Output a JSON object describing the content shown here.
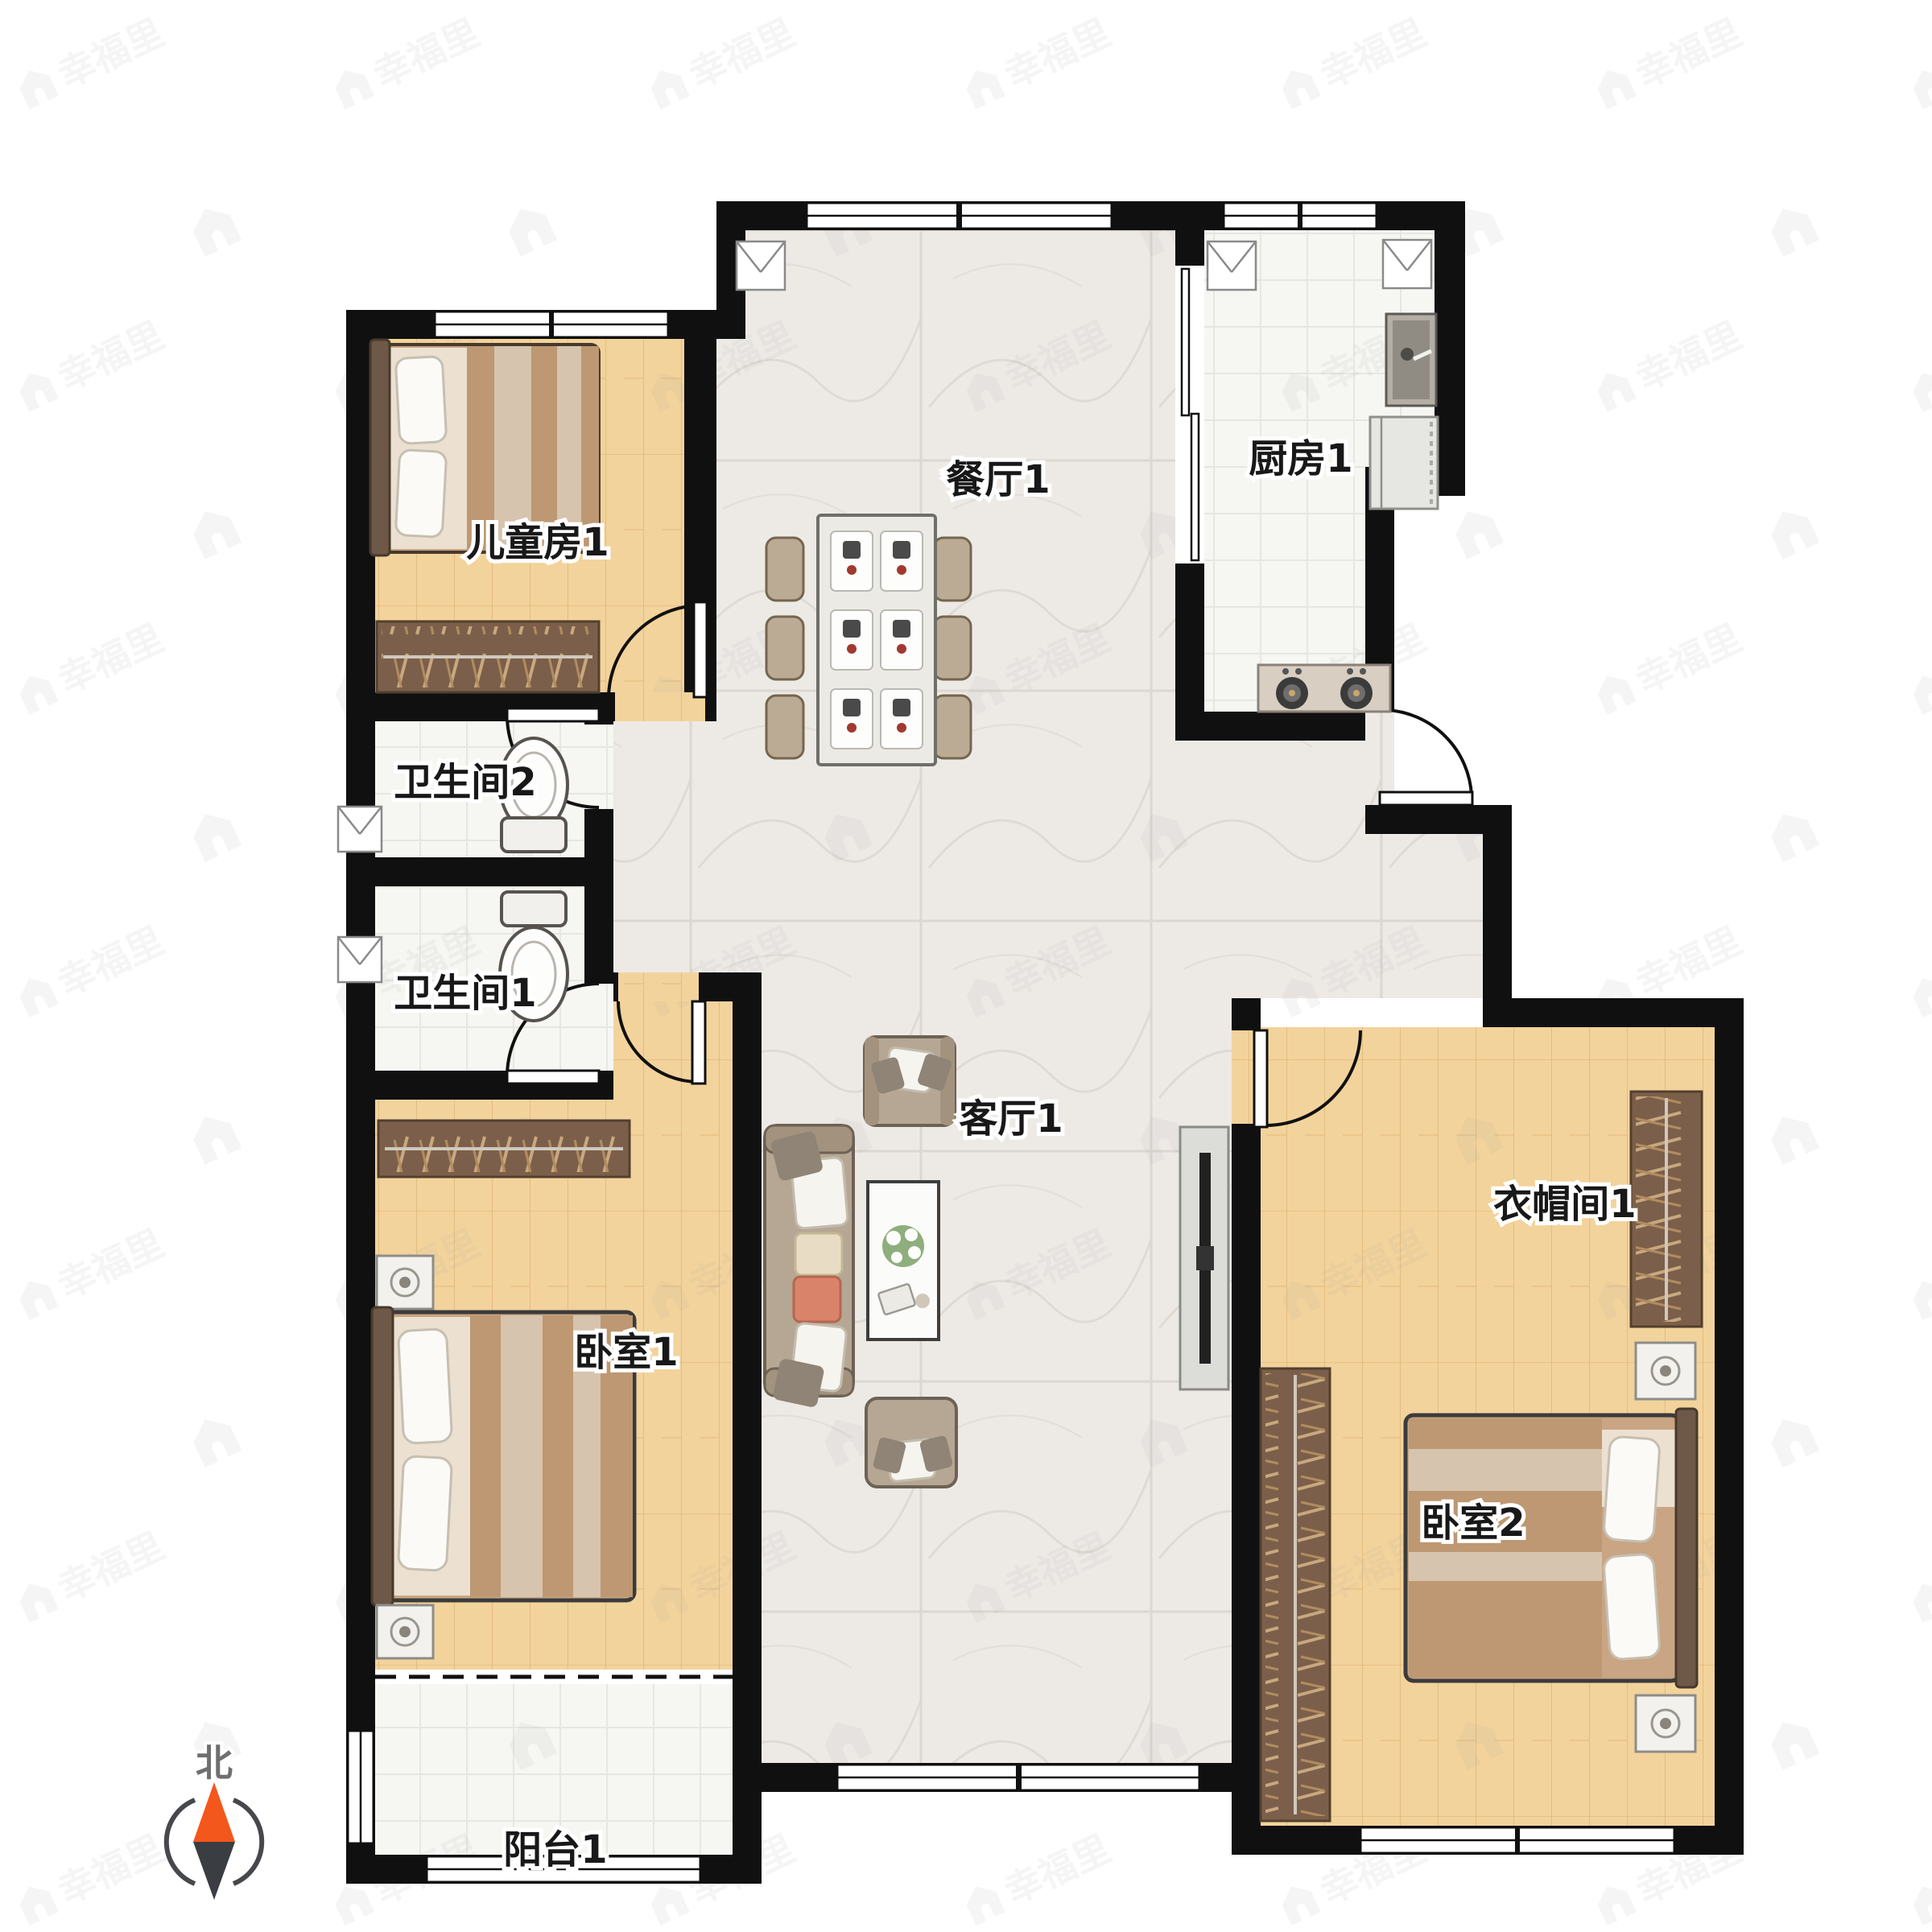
{
  "plan": {
    "type": "apartment-floorplan",
    "rooms": {
      "children_room": {
        "label": "儿童房1"
      },
      "dining": {
        "label": "餐厅1"
      },
      "kitchen": {
        "label": "厨房1"
      },
      "bathroom2": {
        "label": "卫生间2"
      },
      "bathroom1": {
        "label": "卫生间1"
      },
      "living": {
        "label": "客厅1"
      },
      "cloakroom": {
        "label": "衣帽间1"
      },
      "bedroom1": {
        "label": "卧室1"
      },
      "bedroom2": {
        "label": "卧室2"
      },
      "balcony": {
        "label": "阳台1"
      }
    },
    "compass": {
      "north_label": "北"
    },
    "watermark": {
      "brand": "幸福里"
    },
    "colors": {
      "wall": "#101010",
      "wood_floor": "#f3d39c",
      "marble_floor": "#edeae6",
      "tile_floor": "#f6f6f3",
      "wardrobe": "#7c5f4a",
      "compass_north": "#f4571c",
      "compass_south": "#3a3d42"
    }
  }
}
